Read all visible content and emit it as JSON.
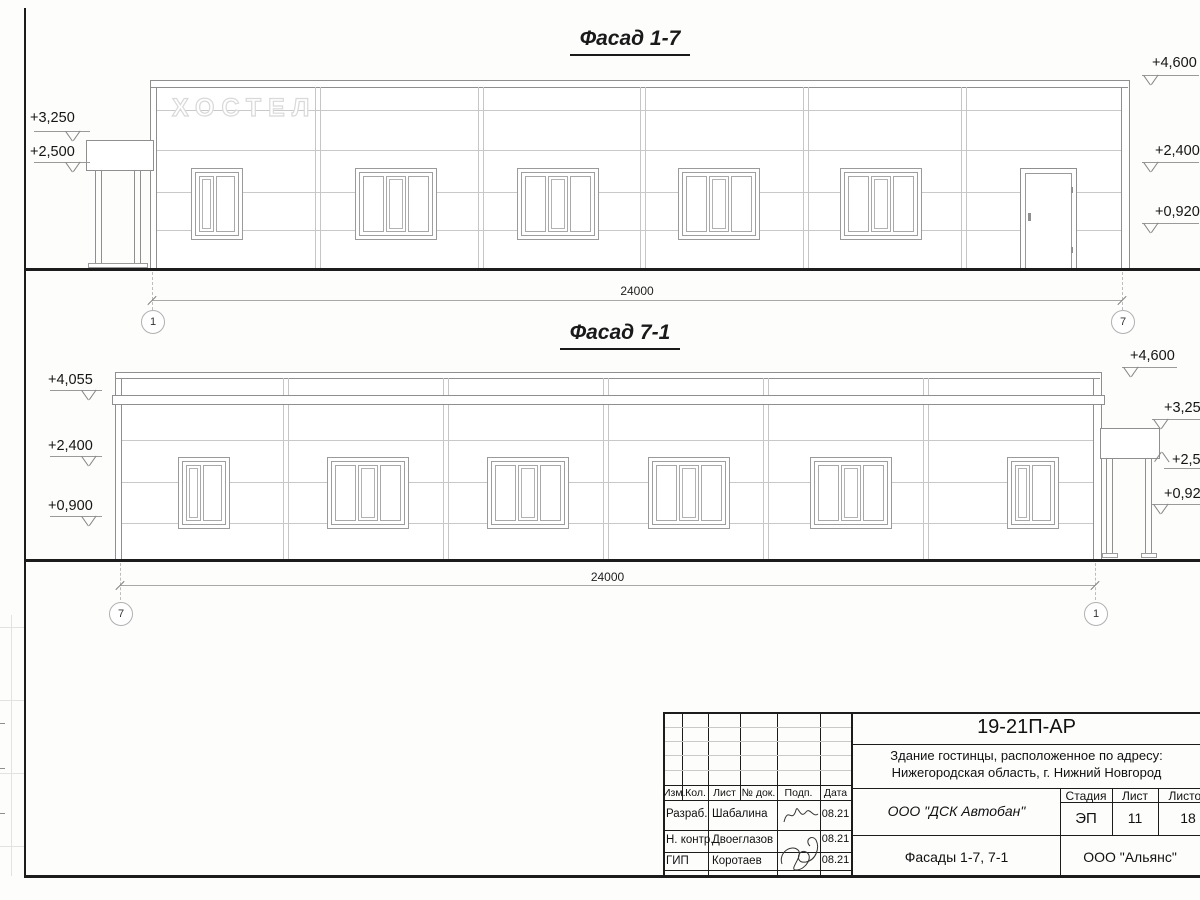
{
  "facade17": {
    "title": "Фасад 1-7",
    "sign": "ХОСТЕЛ",
    "dim": "24000",
    "axis_left": "1",
    "axis_right": "7",
    "marks_left": [
      "+3,250",
      "+2,500"
    ],
    "marks_right": [
      "+4,600",
      "+2,400",
      "+0,920"
    ]
  },
  "facade71": {
    "title": "Фасад 7-1",
    "dim": "24000",
    "axis_left": "7",
    "axis_right": "1",
    "marks_left": [
      "+4,055",
      "+2,400",
      "+0,900"
    ],
    "marks_right": [
      "+4,600",
      "+3,250",
      "+2,500",
      "+0,920"
    ]
  },
  "titleblock": {
    "doc_code": "19-21П-АР",
    "object_line1": "Здание гостинцы, расположенное по адресу:",
    "object_line2": "Нижегородская область, г. Нижний Новгород",
    "header_cols": [
      "Изм.",
      "Кол.",
      "Лист",
      "№ док.",
      "Подп.",
      "Дата"
    ],
    "rows": [
      {
        "role": "Разраб.",
        "name": "Шабалина",
        "date": "08.21"
      },
      {
        "role": "Н. контр.",
        "name": "Двоеглазов",
        "date": "08.21"
      },
      {
        "role": "ГИП",
        "name": "Коротаев",
        "date": "08.21"
      }
    ],
    "contractor": "ООО \"ДСК Автобан\"",
    "stage_label": "Стадия",
    "sheet_label": "Лист",
    "sheets_label": "Листов",
    "stage": "ЭП",
    "sheet_no": "11",
    "sheets_total": "18",
    "drawing_title": "Фасады 1-7, 7-1",
    "firm": "ООО \"Альянс\""
  }
}
